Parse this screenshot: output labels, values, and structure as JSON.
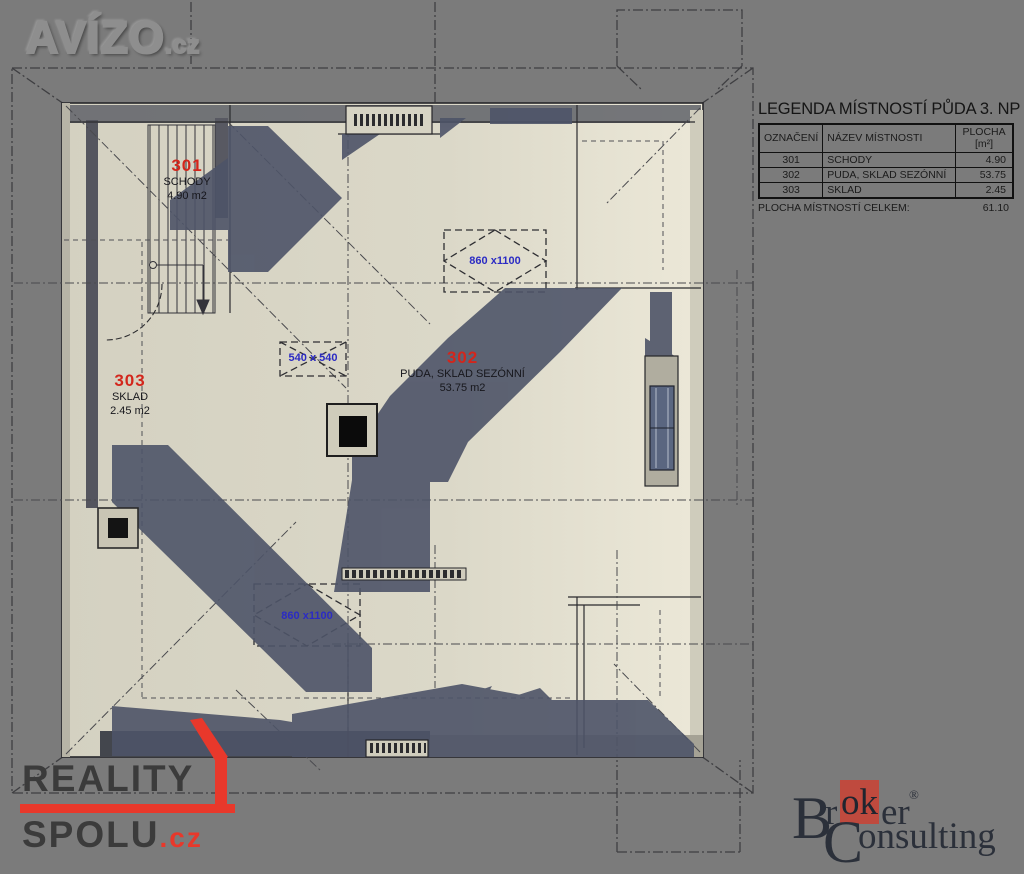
{
  "watermarks": {
    "avizo": {
      "brand": "AVÍZO",
      "tld": ".cz"
    },
    "reality": {
      "line1": "REALITY",
      "line2": "SPOLU",
      "tld": ".cz"
    },
    "broker": {
      "b": "B",
      "r": "r",
      "ok": "ok",
      "er": "er",
      "reg": "®",
      "c": "C",
      "onsulting": "onsulting"
    }
  },
  "legend": {
    "title": "LEGENDA MÍSTNOSTÍ PŮDA 3. NP",
    "col_designation": "OZNAČENÍ",
    "col_name": "NÁZEV MÍSTNOSTI",
    "col_area_line1": "PLOCHA",
    "col_area_line2": "[m²]",
    "rows": [
      {
        "id": "301",
        "name": "SCHODY",
        "area": "4.90"
      },
      {
        "id": "302",
        "name": "PUDA, SKLAD SEZÓNNÍ",
        "area": "53.75"
      },
      {
        "id": "303",
        "name": "SKLAD",
        "area": "2.45"
      }
    ],
    "total_label": "PLOCHA MÍSTNOSTÍ CELKEM:",
    "total_value": "61.10"
  },
  "plan": {
    "floor_title": "PŮDA 3. NP",
    "rooms": [
      {
        "id": "301",
        "name": "SCHODY",
        "area": "4.90 m2"
      },
      {
        "id": "302",
        "name": "PUDA, SKLAD SEZÓNNÍ",
        "area": "53.75 m2"
      },
      {
        "id": "303",
        "name": "SKLAD",
        "area": "2.45 m2"
      }
    ],
    "roof_windows": [
      {
        "size": "860 x1100"
      },
      {
        "size": "540 x 540"
      },
      {
        "size": "860 x1100"
      }
    ]
  },
  "colors": {
    "background": "#7b7b7b",
    "floor": "#d7d4c4",
    "shadow": "#4e5468",
    "room_number_red": "#d3261c",
    "dimension_blue": "#2b2bc4",
    "reality_red": "#e8382b",
    "broker_red": "#bf4a3e",
    "line_dark": "#2b2b2e"
  }
}
